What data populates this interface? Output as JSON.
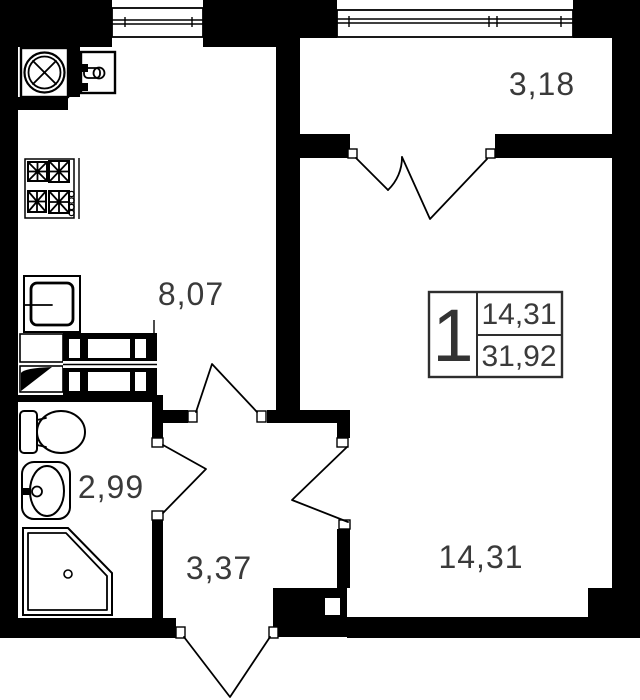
{
  "title": "one-room-apartment-floor-plan",
  "unit_info": {
    "rooms_count": "1",
    "living_area": "14,31",
    "total_area": "31,92"
  },
  "rooms": {
    "balcony": {
      "area": "3,18"
    },
    "kitchen": {
      "area": "8,07"
    },
    "bathroom": {
      "area": "2,99"
    },
    "hallway": {
      "area": "3,37"
    },
    "living_room": {
      "area": "14,31"
    }
  },
  "colors": {
    "wall": "#000000",
    "label": "#3a3a3a",
    "background": "#ffffff",
    "line": "#111111"
  }
}
